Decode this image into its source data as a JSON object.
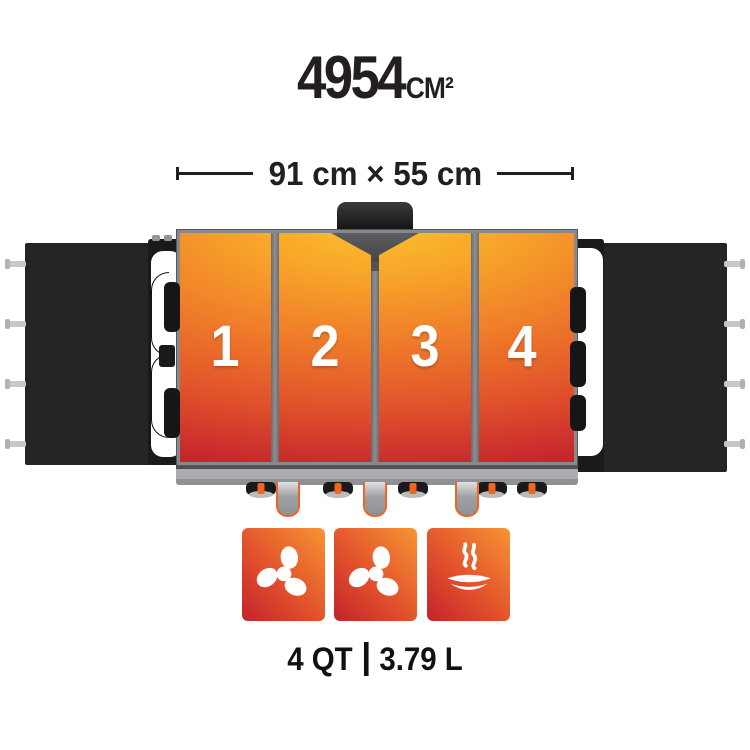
{
  "title": {
    "value": "4954",
    "unit": "CM²"
  },
  "dimensions": {
    "label": "91 cm × 55 cm"
  },
  "griddle": {
    "zones": [
      {
        "label": "1"
      },
      {
        "label": "2"
      },
      {
        "label": "3"
      },
      {
        "label": "4"
      }
    ],
    "colors": {
      "heat_top": "#FBC52D",
      "heat_mid": "#EF7B2A",
      "heat_bottom": "#C2232C",
      "frame": "#87898C",
      "accent_orange": "#F16522"
    }
  },
  "features": {
    "badges": [
      {
        "icon": "fan-icon"
      },
      {
        "icon": "fan-icon"
      },
      {
        "icon": "steam-dish-icon"
      }
    ],
    "badge_colors": {
      "top": "#F79433",
      "bottom": "#C3232C"
    }
  },
  "capacity": {
    "quarts": "4 QT",
    "liters": "3.79 L"
  }
}
